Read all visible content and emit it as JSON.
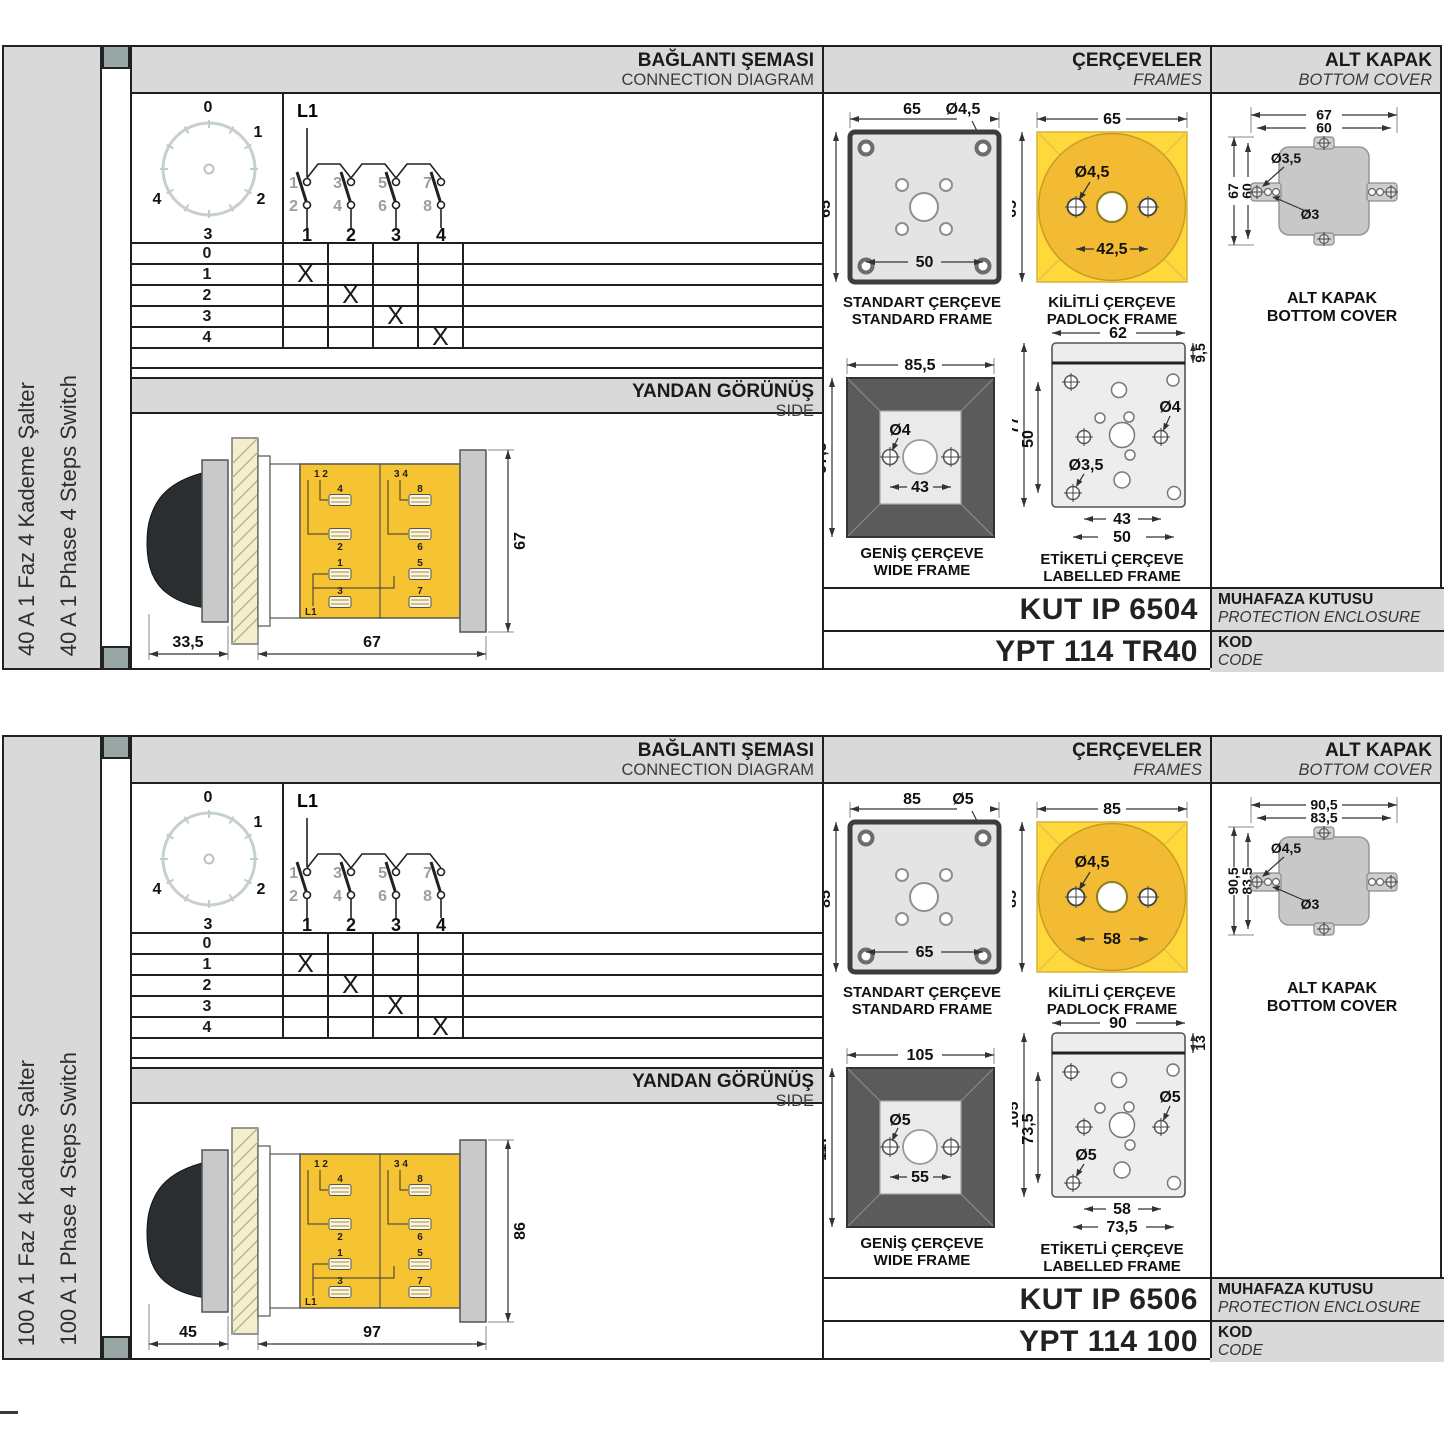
{
  "colors": {
    "accent_yellow": "#f6c433",
    "padlock_yellow": "#ffd83c",
    "band_gray": "#d9d9d9",
    "dark_frame": "#5b5b5b"
  },
  "panels": [
    {
      "sidebar_tr": "40 A 1 Faz 4 Kademe Şalter",
      "sidebar_en": "40 A 1 Phase 4 Steps Switch",
      "conn": {
        "title_tr": "BAĞLANTI ŞEMASI",
        "title_en": "CONNECTION DIAGRAM",
        "phase": "L1",
        "dial": [
          "0",
          "1",
          "2",
          "3",
          "4"
        ],
        "top_nums": [
          "1",
          "3",
          "5",
          "7"
        ],
        "bottom_nums": [
          "2",
          "4",
          "6",
          "8"
        ],
        "pole_nums": [
          "1",
          "2",
          "3",
          "4"
        ],
        "rows": [
          {
            "label": "0",
            "marks": [
              "",
              "",
              "",
              ""
            ]
          },
          {
            "label": "1",
            "marks": [
              "X",
              "",
              "",
              ""
            ]
          },
          {
            "label": "2",
            "marks": [
              "",
              "X",
              "",
              ""
            ]
          },
          {
            "label": "3",
            "marks": [
              "",
              "",
              "X",
              ""
            ]
          },
          {
            "label": "4",
            "marks": [
              "",
              "",
              "",
              "X"
            ]
          }
        ]
      },
      "side": {
        "title_tr": "YANDAN GÖRÜNÜŞ",
        "title_en": "SIDE",
        "dim_a": "33,5",
        "dim_b": "67",
        "dim_h": "67",
        "pair_left": "1 2",
        "pair_right": "3 4",
        "ul": [
          "4",
          "2"
        ],
        "ur": [
          "8",
          "6"
        ],
        "ll": [
          "1",
          "3"
        ],
        "lr": [
          "5",
          "7"
        ],
        "phase": "L1"
      },
      "frames": {
        "title_tr": "ÇERÇEVELER",
        "title_en": "FRAMES",
        "standard": {
          "cap_tr": "STANDART ÇERÇEVE",
          "cap_en": "STANDARD FRAME",
          "w": "65",
          "h": "65",
          "hole": "Ø4,5",
          "pitch": "50"
        },
        "padlock": {
          "cap_tr": "KİLİTLİ ÇERÇEVE",
          "cap_en": "PADLOCK FRAME",
          "w": "65",
          "h": "65",
          "hole": "Ø4,5",
          "pitch": "42,5"
        },
        "wide": {
          "cap_tr": "GENİŞ ÇERÇEVE",
          "cap_en": "WIDE FRAME",
          "w": "85,5",
          "h": "97,5",
          "hole": "Ø4",
          "pitch": "43"
        },
        "labelled": {
          "cap_tr": "ETİKETLİ ÇERÇEVE",
          "cap_en": "LABELLED FRAME",
          "w": "62",
          "strip": "9,5",
          "h": "77",
          "h_inner": "50",
          "hole_r": "Ø4",
          "hole_l": "Ø3,5",
          "pitch1": "43",
          "pitch2": "50"
        }
      },
      "cover": {
        "title_tr": "ALT KAPAK",
        "title_en": "BOTTOM COVER",
        "cap_tr": "ALT KAPAK",
        "cap_en": "BOTTOM COVER",
        "w1": "67",
        "w2": "60",
        "h1": "67",
        "h2": "60",
        "hole1": "Ø3,5",
        "hole2": "Ø3"
      },
      "enclosure": {
        "value": "KUT IP 6504",
        "label_tr": "MUHAFAZA KUTUSU",
        "label_en": "PROTECTION ENCLOSURE"
      },
      "code": {
        "value": "YPT 114 TR40",
        "label_tr": "KOD",
        "label_en": "CODE"
      }
    },
    {
      "sidebar_tr": "100 A 1 Faz 4 Kademe Şalter",
      "sidebar_en": "100 A 1 Phase 4 Steps Switch",
      "conn": {
        "title_tr": "BAĞLANTI ŞEMASI",
        "title_en": "CONNECTION DIAGRAM",
        "phase": "L1",
        "dial": [
          "0",
          "1",
          "2",
          "3",
          "4"
        ],
        "top_nums": [
          "1",
          "3",
          "5",
          "7"
        ],
        "bottom_nums": [
          "2",
          "4",
          "6",
          "8"
        ],
        "pole_nums": [
          "1",
          "2",
          "3",
          "4"
        ],
        "rows": [
          {
            "label": "0",
            "marks": [
              "",
              "",
              "",
              ""
            ]
          },
          {
            "label": "1",
            "marks": [
              "X",
              "",
              "",
              ""
            ]
          },
          {
            "label": "2",
            "marks": [
              "",
              "X",
              "",
              ""
            ]
          },
          {
            "label": "3",
            "marks": [
              "",
              "",
              "X",
              ""
            ]
          },
          {
            "label": "4",
            "marks": [
              "",
              "",
              "",
              "X"
            ]
          }
        ]
      },
      "side": {
        "title_tr": "YANDAN GÖRÜNÜŞ",
        "title_en": "SIDE",
        "dim_a": "45",
        "dim_b": "97",
        "dim_h": "86",
        "pair_left": "1 2",
        "pair_right": "3 4",
        "ul": [
          "4",
          "2"
        ],
        "ur": [
          "8",
          "6"
        ],
        "ll": [
          "1",
          "3"
        ],
        "lr": [
          "5",
          "7"
        ],
        "phase": "L1"
      },
      "frames": {
        "title_tr": "ÇERÇEVELER",
        "title_en": "FRAMES",
        "standard": {
          "cap_tr": "STANDART ÇERÇEVE",
          "cap_en": "STANDARD FRAME",
          "w": "85",
          "h": "85",
          "hole": "Ø5",
          "pitch": "65"
        },
        "padlock": {
          "cap_tr": "KİLİTLİ ÇERÇEVE",
          "cap_en": "PADLOCK FRAME",
          "w": "85",
          "h": "85",
          "hole": "Ø4,5",
          "pitch": "58"
        },
        "wide": {
          "cap_tr": "GENİŞ ÇERÇEVE",
          "cap_en": "WIDE FRAME",
          "w": "105",
          "h": "117",
          "hole": "Ø5",
          "pitch": "55"
        },
        "labelled": {
          "cap_tr": "ETİKETLİ ÇERÇEVE",
          "cap_en": "LABELLED FRAME",
          "w": "90",
          "strip": "13",
          "h": "105",
          "h_inner": "73,5",
          "hole_r": "Ø5",
          "hole_l": "Ø5",
          "pitch1": "58",
          "pitch2": "73,5"
        }
      },
      "cover": {
        "title_tr": "ALT KAPAK",
        "title_en": "BOTTOM COVER",
        "cap_tr": "ALT KAPAK",
        "cap_en": "BOTTOM COVER",
        "w1": "90,5",
        "w2": "83,5",
        "h1": "90,5",
        "h2": "83,5",
        "hole1": "Ø4,5",
        "hole2": "Ø3"
      },
      "enclosure": {
        "value": "KUT IP 6506",
        "label_tr": "MUHAFAZA KUTUSU",
        "label_en": "PROTECTION ENCLOSURE"
      },
      "code": {
        "value": "YPT 114 100",
        "label_tr": "KOD",
        "label_en": "CODE"
      }
    }
  ]
}
